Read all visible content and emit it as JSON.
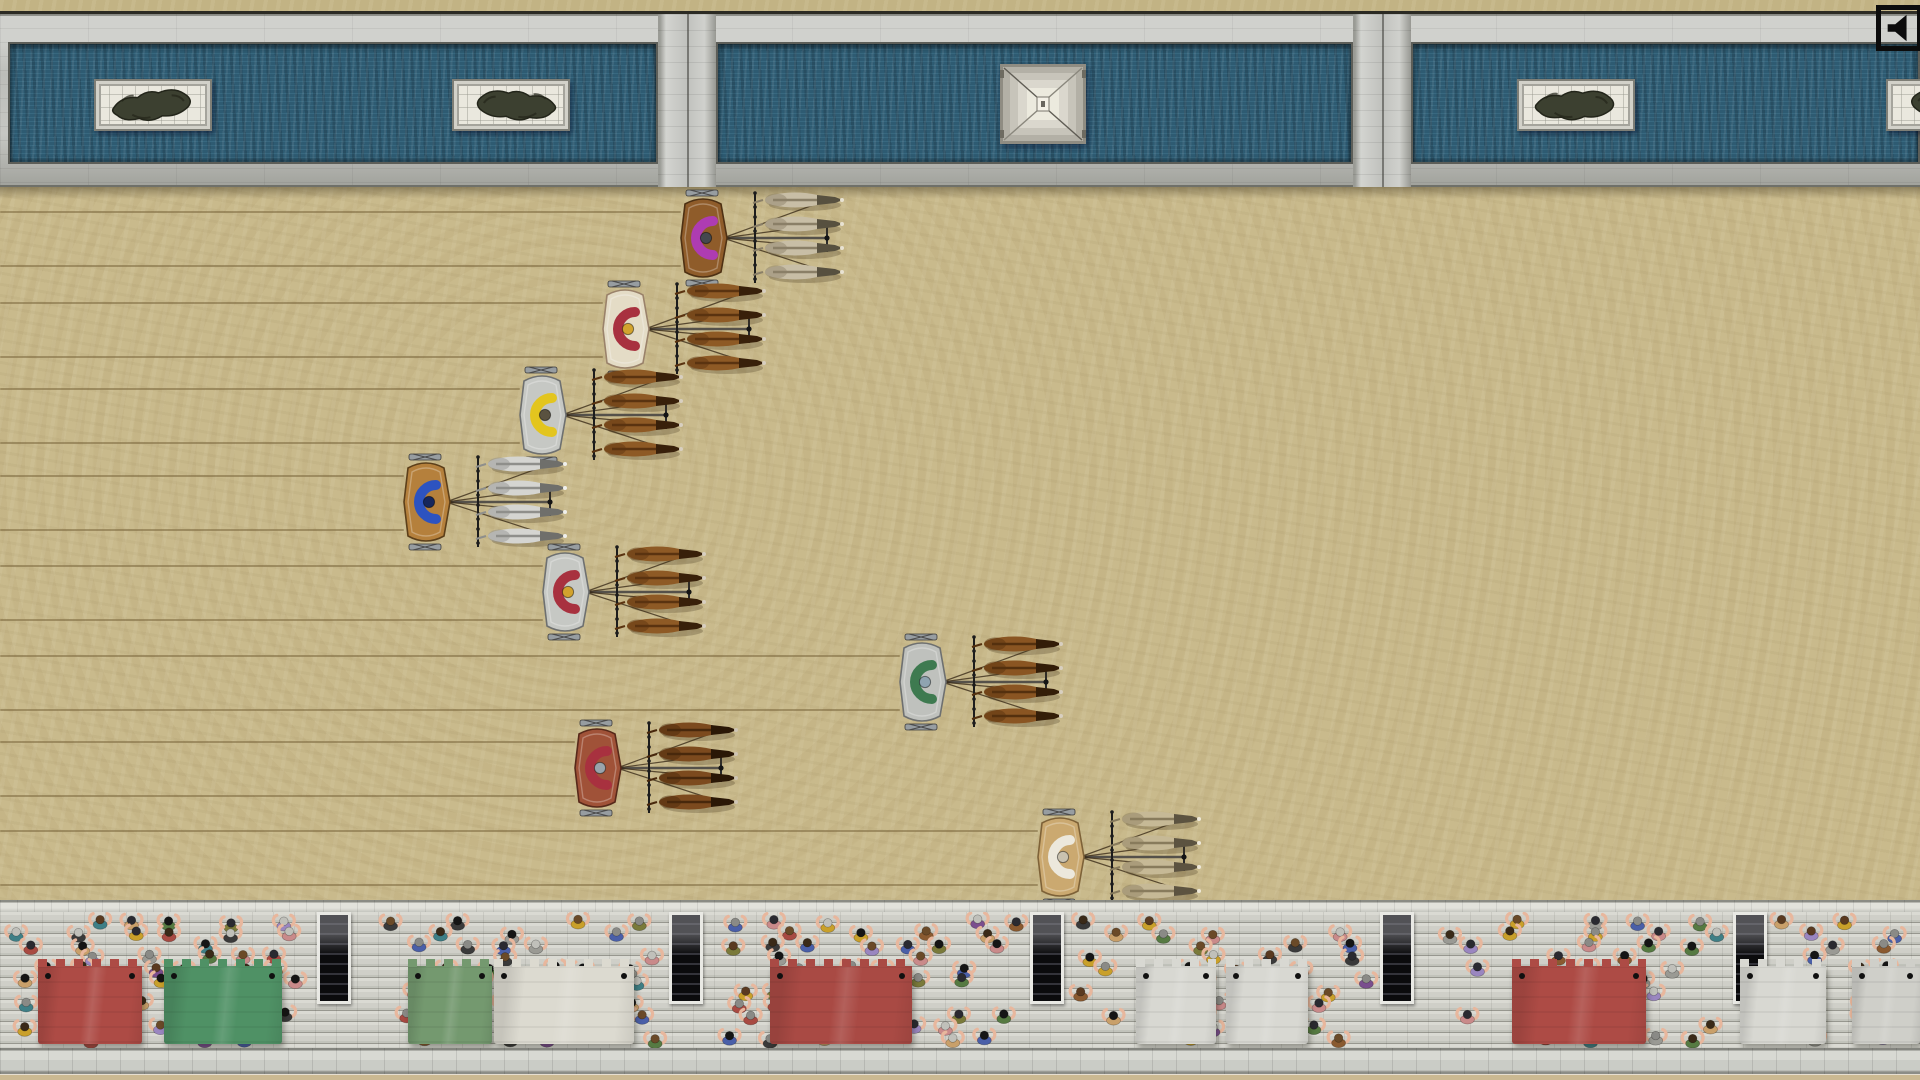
{
  "scene": {
    "name": "top-down chariot race in roman circus",
    "view": "overhead"
  },
  "sound_button": {
    "icon": "speaker-icon",
    "state": "sound-on"
  },
  "palette": {
    "sand": "#c9ba8c",
    "marble": "#c6c7c3",
    "water": "#2e5b72",
    "stand_stone": "#cfcfc8",
    "rut": "#7a663c"
  },
  "spina": {
    "water_basins": [
      {
        "x": 8,
        "width": 650
      },
      {
        "x": 716,
        "width": 637
      },
      {
        "x": 1411,
        "width": 509
      }
    ],
    "dividers": [
      {
        "x": 658,
        "width": 58
      },
      {
        "x": 1353,
        "width": 58
      }
    ],
    "statues": [
      {
        "name": "bronze-statue-1",
        "x": 153,
        "flip": 1,
        "rot": -2
      },
      {
        "name": "bronze-statue-2",
        "x": 511,
        "flip": -1,
        "rot": 2
      },
      {
        "name": "bronze-statue-3",
        "x": 1576,
        "flip": 1,
        "rot": 3
      },
      {
        "name": "bronze-statue-4",
        "x": 1945,
        "flip": -1,
        "rot": -2
      }
    ],
    "monument": {
      "name": "stepped-pyramid-monument",
      "x": 1043,
      "y": 104
    }
  },
  "chariots": [
    {
      "team": "purple",
      "x": 703,
      "y": 238,
      "cart": "#8f5c2a",
      "cart_stroke": "#4e3114",
      "driver": "#ae3cb2",
      "helmet": "#44484e",
      "horse": "#c8bea6",
      "horse_mane": "#8a7f67",
      "horse_head": "#57503f",
      "muzzle": "#e8e2d2"
    },
    {
      "team": "red",
      "x": 625,
      "y": 329,
      "cart": "#e4dcc6",
      "cart_stroke": "#9a826a",
      "driver": "#a8313f",
      "helmet": "#d2a32e",
      "horse": "#8e5a25",
      "horse_mane": "#5a3310",
      "horse_head": "#38200a",
      "muzzle": "#d8cfc0"
    },
    {
      "team": "yellow",
      "x": 542,
      "y": 415,
      "cart": "#c6c8c4",
      "cart_stroke": "#6e7070",
      "driver": "#e3c51e",
      "helmet": "#5a5240",
      "horse": "#8e5a25",
      "horse_mane": "#5a3310",
      "horse_head": "#38200a",
      "muzzle": "#d8cfc0"
    },
    {
      "team": "blue",
      "x": 426,
      "y": 502,
      "cart": "#b5803c",
      "cart_stroke": "#5c3f1a",
      "driver": "#2d53c0",
      "helmet": "#16265c",
      "horse": "#d5d5d1",
      "horse_mane": "#8f8f8b",
      "horse_head": "#6f6f6b",
      "muzzle": "#f0f0ec"
    },
    {
      "team": "red",
      "x": 565,
      "y": 592,
      "cart": "#c6c8c4",
      "cart_stroke": "#6e7070",
      "driver": "#a8313f",
      "helmet": "#d2a32e",
      "horse": "#8e5a25",
      "horse_mane": "#5a3310",
      "horse_head": "#38200a",
      "muzzle": "#d8cfc0"
    },
    {
      "team": "green",
      "x": 922,
      "y": 682,
      "cart": "#bfc1bd",
      "cart_stroke": "#6e7070",
      "driver": "#3e7a50",
      "helmet": "#8fa3b0",
      "horse": "#8a5522",
      "horse_mane": "#54300e",
      "horse_head": "#331d08",
      "muzzle": "#d8cfc0"
    },
    {
      "team": "red",
      "x": 597,
      "y": 768,
      "cart": "#a05238",
      "cart_stroke": "#57291a",
      "driver": "#a8313f",
      "helmet": "#9aa4ac",
      "horse": "#7c4a1e",
      "horse_mane": "#48280c",
      "horse_head": "#2a1706",
      "muzzle": "#cfc5b4"
    },
    {
      "team": "white",
      "x": 1060,
      "y": 857,
      "cart": "#cba970",
      "cart_stroke": "#7e6238",
      "driver": "#ece8dc",
      "helmet": "#c9c2b0",
      "horse": "#c6b996",
      "horse_mane": "#887b5c",
      "horse_head": "#5c5340",
      "muzzle": "#efe9da"
    }
  ],
  "stands": {
    "stairways": [
      {
        "x": 334
      },
      {
        "x": 686
      },
      {
        "x": 1047
      },
      {
        "x": 1397
      },
      {
        "x": 1750
      }
    ],
    "awnings": [
      {
        "color": "#ad4b45",
        "name": "red-awning",
        "x": 38,
        "width": 104
      },
      {
        "color": "#4f9165",
        "name": "green-awning",
        "x": 164,
        "width": 118
      },
      {
        "color": "#74996f",
        "name": "green-awning",
        "x": 408,
        "width": 84
      },
      {
        "color": "#dcdad0",
        "name": "cream-awning",
        "x": 494,
        "width": 140
      },
      {
        "color": "#a94a44",
        "name": "red-awning",
        "x": 770,
        "width": 142
      },
      {
        "color": "#d8d8d2",
        "name": "white-awning",
        "x": 1136,
        "width": 80
      },
      {
        "color": "#d8d8d2",
        "name": "white-awning",
        "x": 1226,
        "width": 82
      },
      {
        "color": "#ad4b45",
        "name": "red-awning",
        "x": 1512,
        "width": 134
      },
      {
        "color": "#d8d8d2",
        "name": "white-awning",
        "x": 1740,
        "width": 86
      },
      {
        "color": "#cfcfc9",
        "name": "white-awning",
        "x": 1852,
        "width": 68
      }
    ],
    "crowd": {
      "arm_color": "#e8b79d",
      "head_colors": [
        "#151515",
        "#3a2a18",
        "#6a4a28",
        "#8a8a86",
        "#c0c0ba",
        "#5a3a20",
        "#2a2a30"
      ],
      "torso_colors": [
        "#a84a42",
        "#4a5fa8",
        "#7a4e8e",
        "#7a7a3a",
        "#8a5a30",
        "#3f7f86",
        "#9a9a94",
        "#c9a06a",
        "#3a3a3a",
        "#c98a8a",
        "#c9a02a",
        "#9a86c0",
        "#567a42"
      ],
      "seed": 1234
    }
  }
}
